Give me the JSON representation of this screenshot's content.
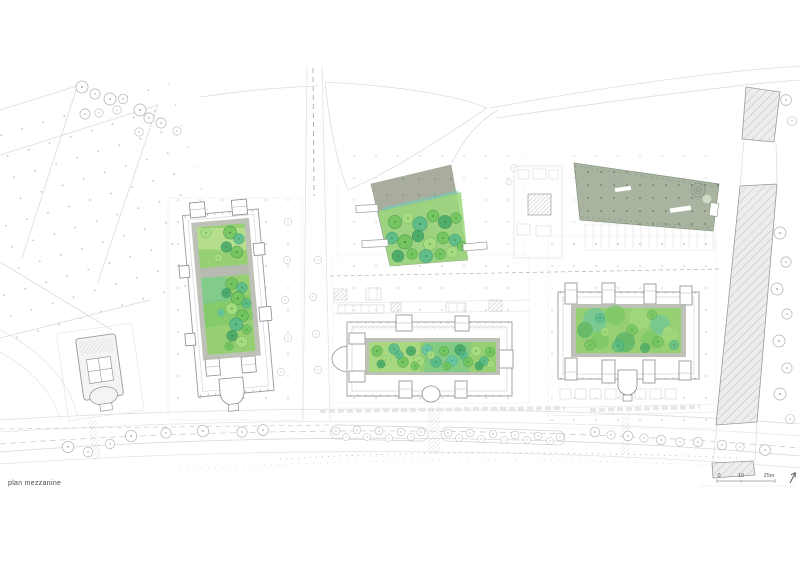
{
  "caption": "plan mezzanine",
  "scale_bar": {
    "labels": [
      "0",
      "10",
      "25m"
    ]
  },
  "icons": {
    "north_arrow": "north-arrow"
  },
  "colors": {
    "green-base": "#97d073",
    "green-1": "#6fc45c",
    "green-2": "#53b98b",
    "green-3": "#a8dd82",
    "green-4": "#3da465",
    "teal": "#5fc3ad",
    "plaza-olive": "#a8ad9e",
    "roof-sage": "#a9b4a0",
    "frame-gray": "#b6bab0",
    "outline-gray": "#9a9a9a",
    "faint-gray": "#e2e2e2",
    "hatch-fill": "#ededed",
    "ink": "#4a4a4a"
  }
}
